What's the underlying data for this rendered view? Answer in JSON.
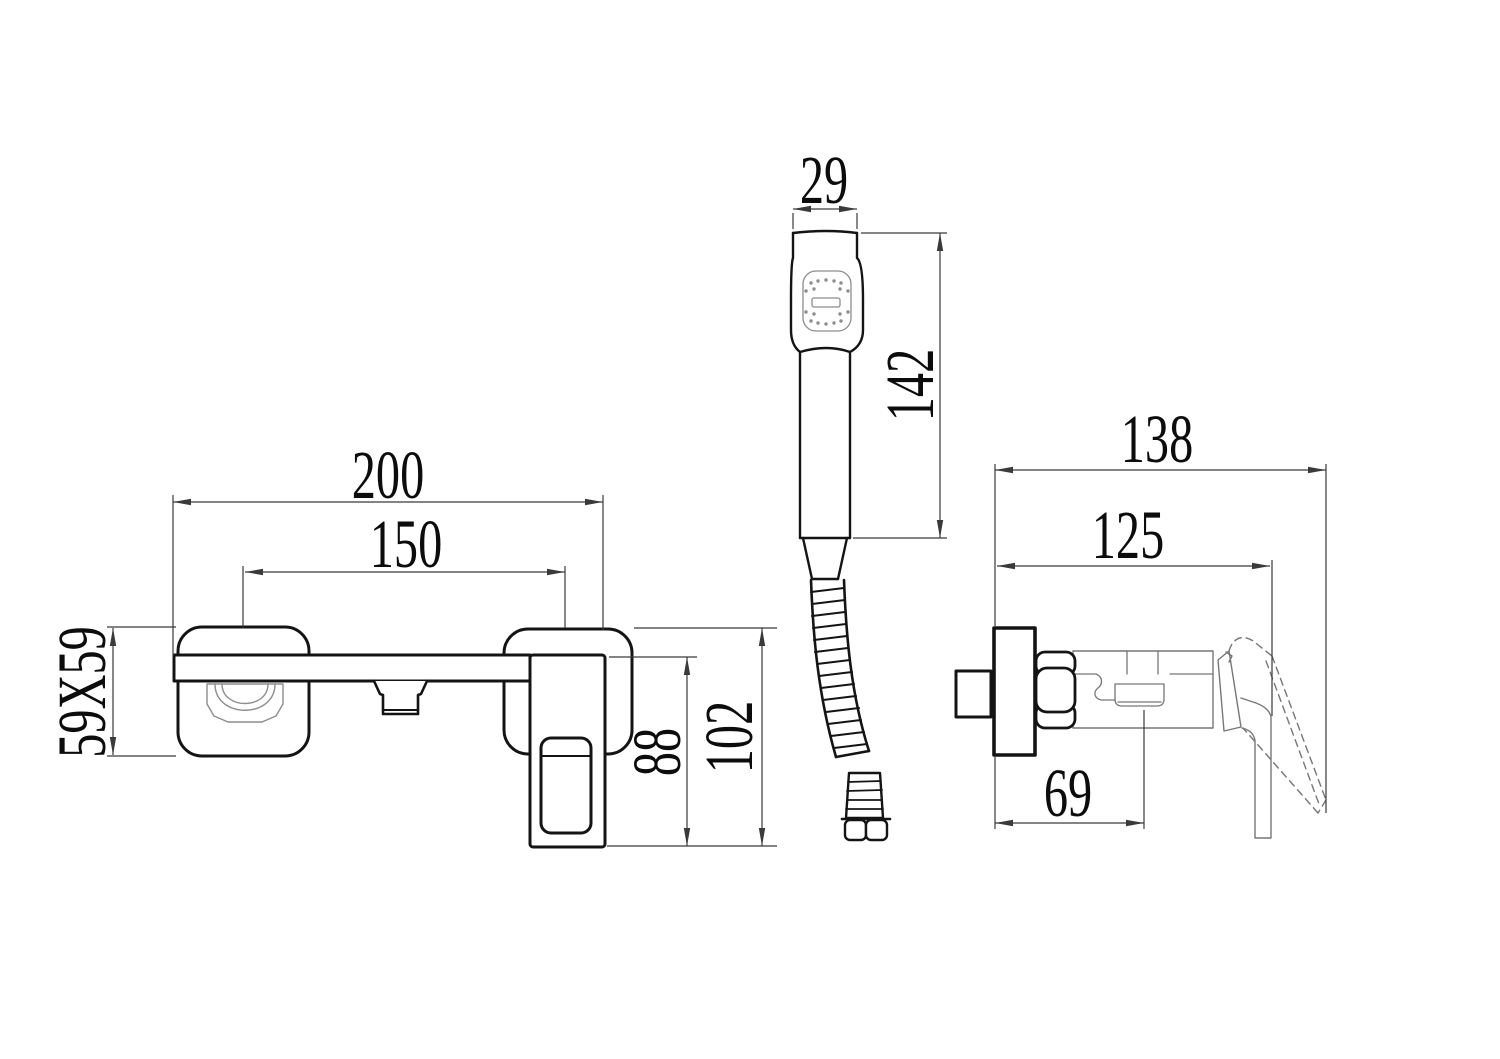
{
  "drawing": {
    "type": "technical-dimension-drawing",
    "colors": {
      "background": "#ffffff",
      "outline": "#141414",
      "dimension": "#3a3a3a",
      "detail": "#8d8d8d"
    },
    "views": {
      "front": {
        "dimensions": {
          "total_width": "200",
          "port_centers": "150",
          "escutcheon_plate": "59X59",
          "body_height": "88",
          "total_height": "102"
        }
      },
      "hand_shower": {
        "dimensions": {
          "head_width": "29",
          "wand_length": "142"
        }
      },
      "side": {
        "dimensions": {
          "total_depth": "138",
          "depth_to_handle": "125",
          "depth_to_spout": "69"
        }
      }
    }
  }
}
